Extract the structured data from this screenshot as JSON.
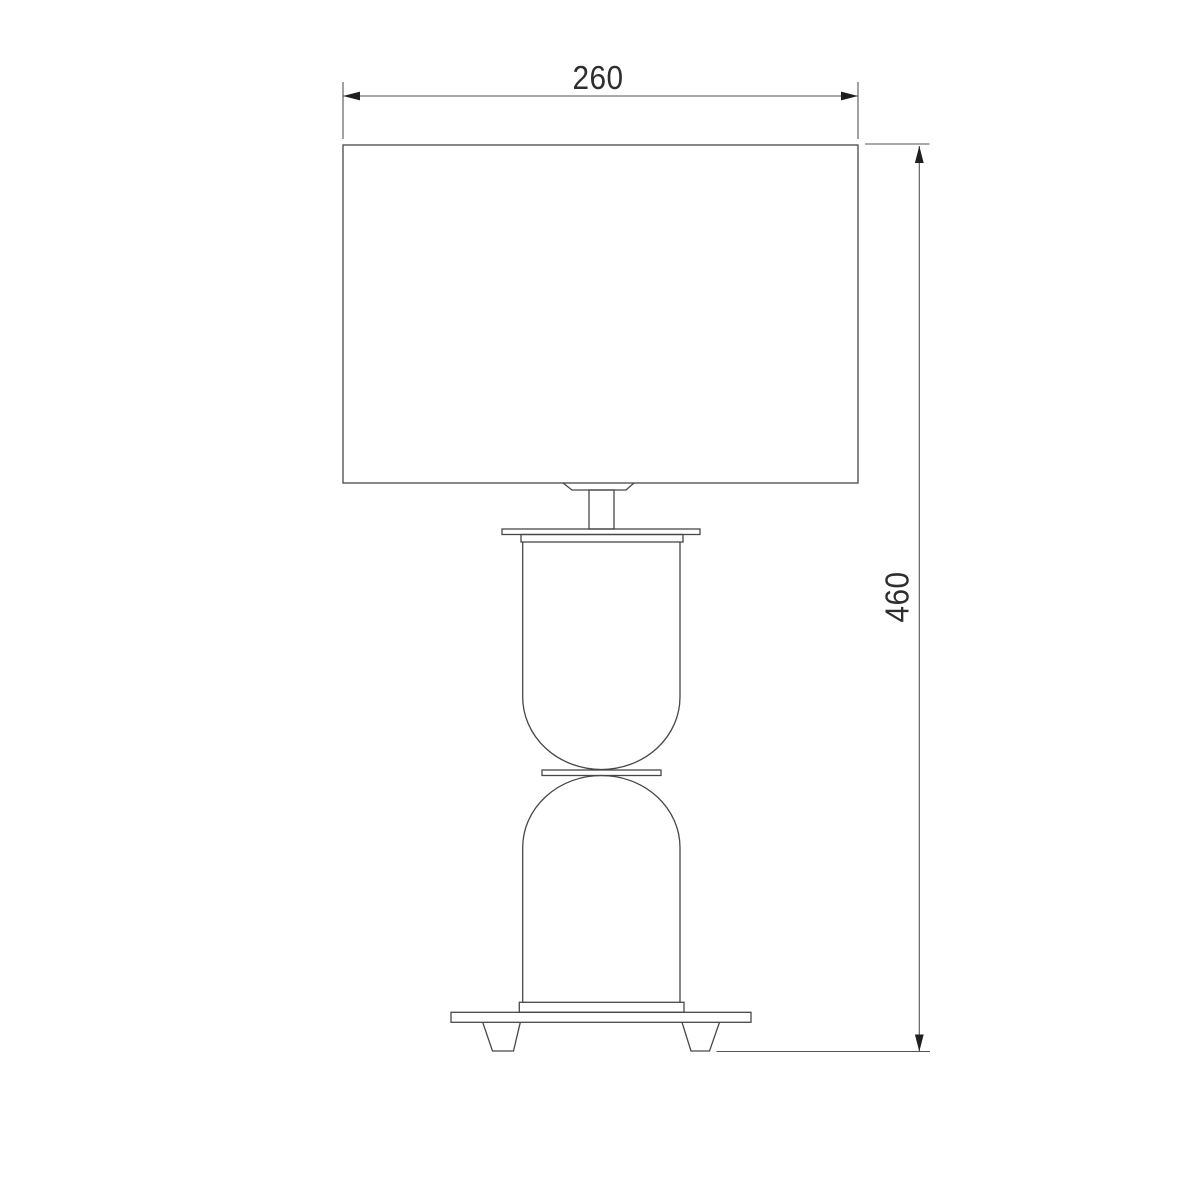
{
  "drawing": {
    "type": "technical-dimension-drawing",
    "subject": "table-lamp-front-view",
    "width_dimension": {
      "value": "260"
    },
    "height_dimension": {
      "value": "460"
    }
  },
  "colors": {
    "line": "#474747",
    "dimension_line": "#545454",
    "arrow": "#1f1f1f",
    "text": "#2e2e2e",
    "background": "#ffffff"
  }
}
